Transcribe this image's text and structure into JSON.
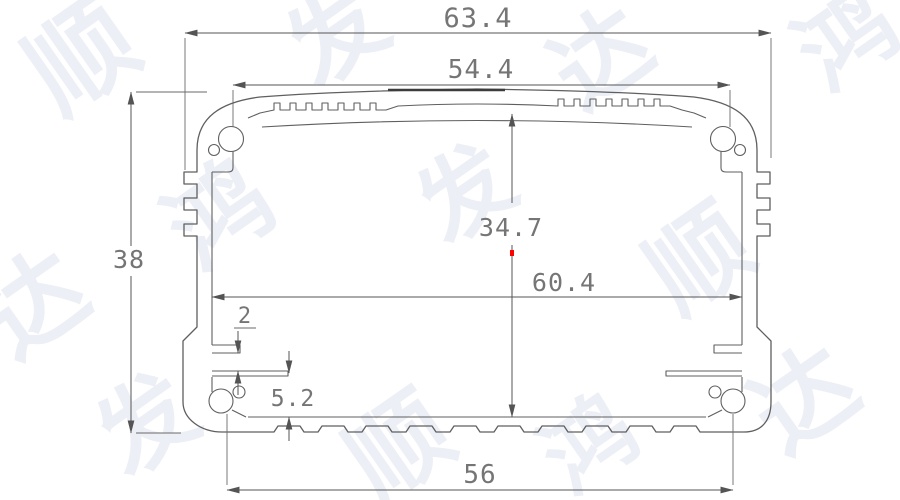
{
  "drawing_type": "aluminum extrusion enclosure cross-section",
  "dimensions": {
    "overall_width": "63.4",
    "lid_width": "54.4",
    "overall_height": "38",
    "inner_height": "34.7",
    "inner_width": "60.4",
    "pcb_slot_gap": "2",
    "pcb_slot_height": "5.2",
    "screw_hole_spacing": "56"
  },
  "colors": {
    "background": "#ffffff",
    "profile-line": "#5f5f5f",
    "dimension-line": "#545454",
    "dimension-text": "#757575",
    "red-marker": "#ff0000",
    "watermark": "#edeff6"
  },
  "watermarks": [
    {
      "char": "顺"
    },
    {
      "char": "发"
    },
    {
      "char": "达"
    },
    {
      "char": "鸿"
    },
    {
      "char": "鸿"
    },
    {
      "char": "发"
    },
    {
      "char": "顺"
    },
    {
      "char": "达"
    },
    {
      "char": "发"
    },
    {
      "char": "顺"
    },
    {
      "char": "达"
    },
    {
      "char": "鸿"
    }
  ]
}
